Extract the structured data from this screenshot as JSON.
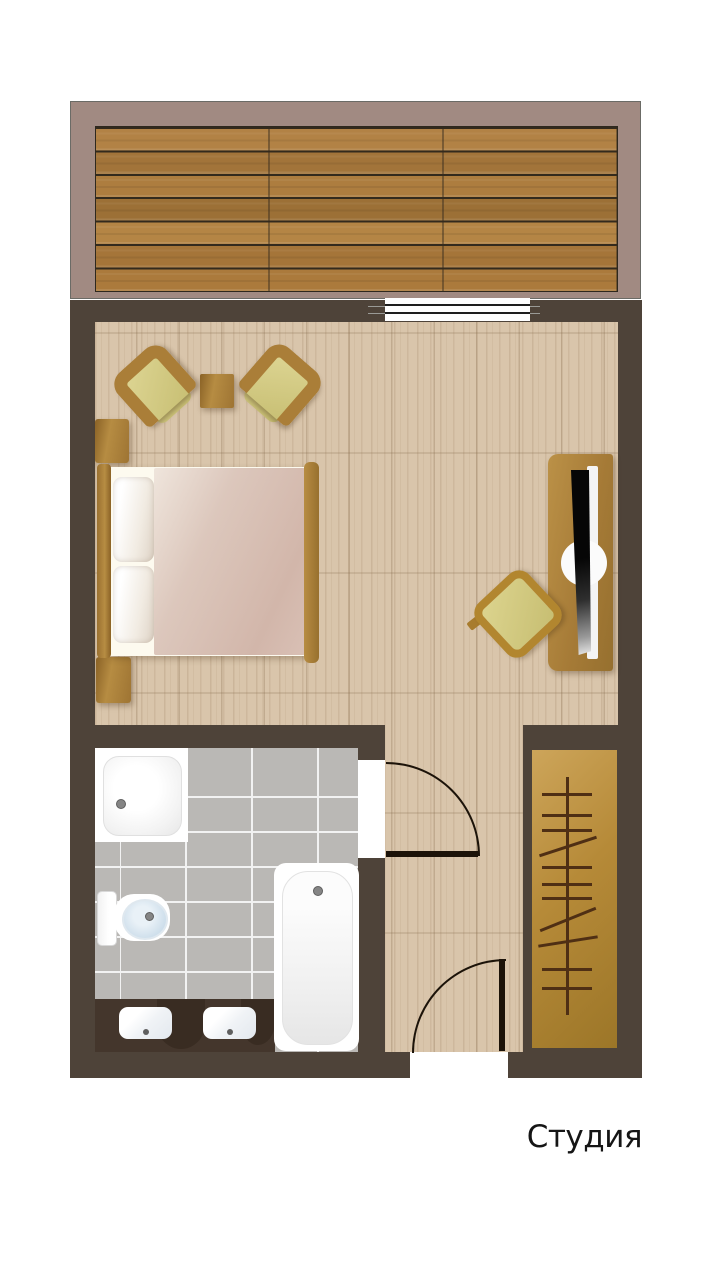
{
  "title": {
    "label": "Студия"
  },
  "colors": {
    "wall": "#4e4339",
    "balcony": "#a18a82",
    "deck": "#a97a3b",
    "deck-gap": "#332a1d",
    "floor": "#d9c5ab",
    "tile": "#bab8b5",
    "grout": "#f2f2f2",
    "furniture": "#aa7e38",
    "cushion": "#c7be72",
    "wardrobe": "#b68a38",
    "hanger": "#4f2f14",
    "blanket": "#dcc7bc",
    "linen": "#fdfaef",
    "vanity": "#44362c",
    "water": "#c9dbe9",
    "line": "#1c1309",
    "text": "#151515"
  }
}
